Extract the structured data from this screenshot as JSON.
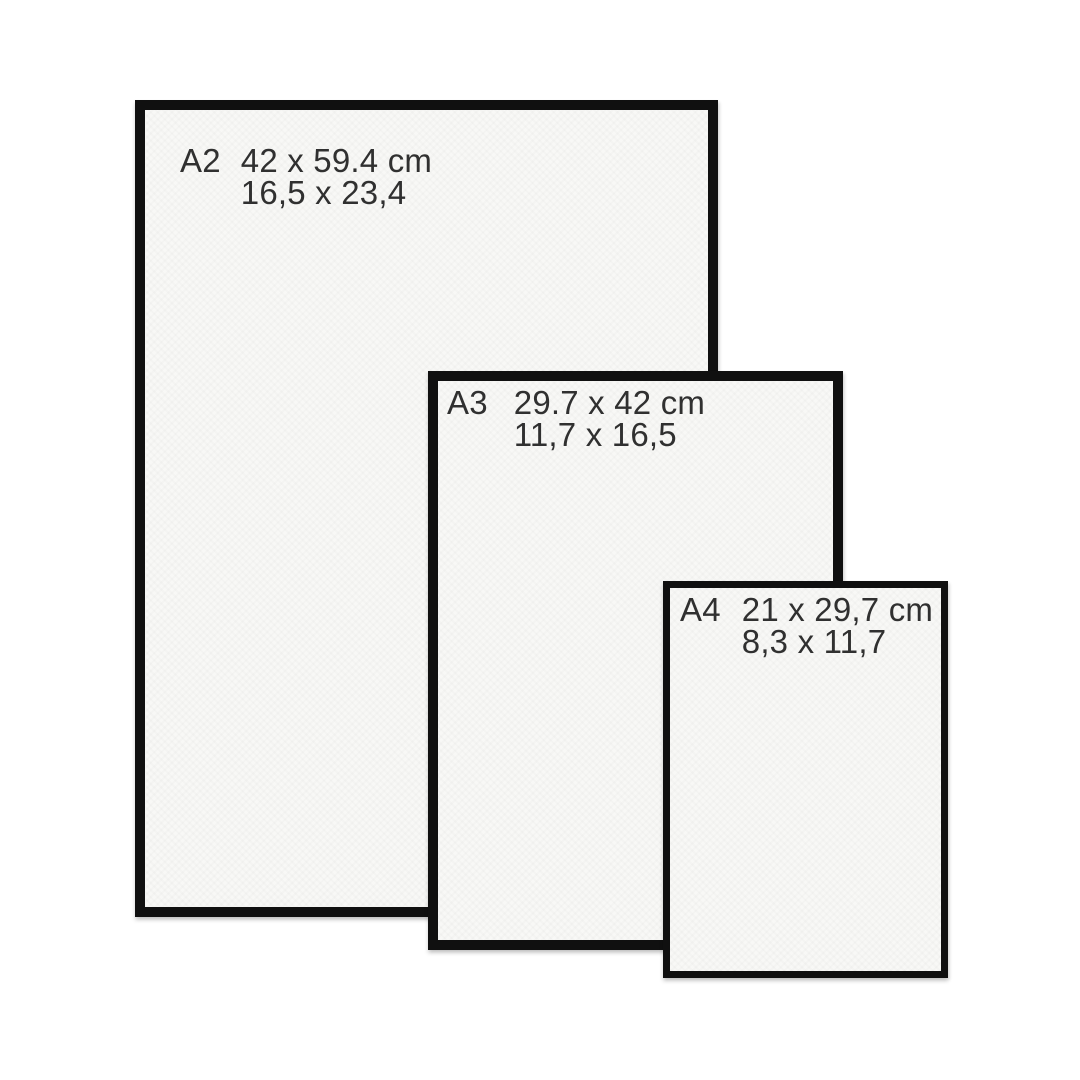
{
  "title": "Paper size comparison guide",
  "colors": {
    "background": "#ffffff",
    "frame": "#101010",
    "paper": "#f8f8f6",
    "text": "#303030"
  },
  "frames": [
    {
      "code": "A2",
      "cm": "42 x 59.4 cm",
      "inches": "16,5 x 23,4"
    },
    {
      "code": "A3",
      "cm": "29.7 x 42 cm",
      "inches": "11,7 x 16,5"
    },
    {
      "code": "A4",
      "cm": "21 x 29,7 cm",
      "inches": "8,3 x 11,7"
    }
  ]
}
